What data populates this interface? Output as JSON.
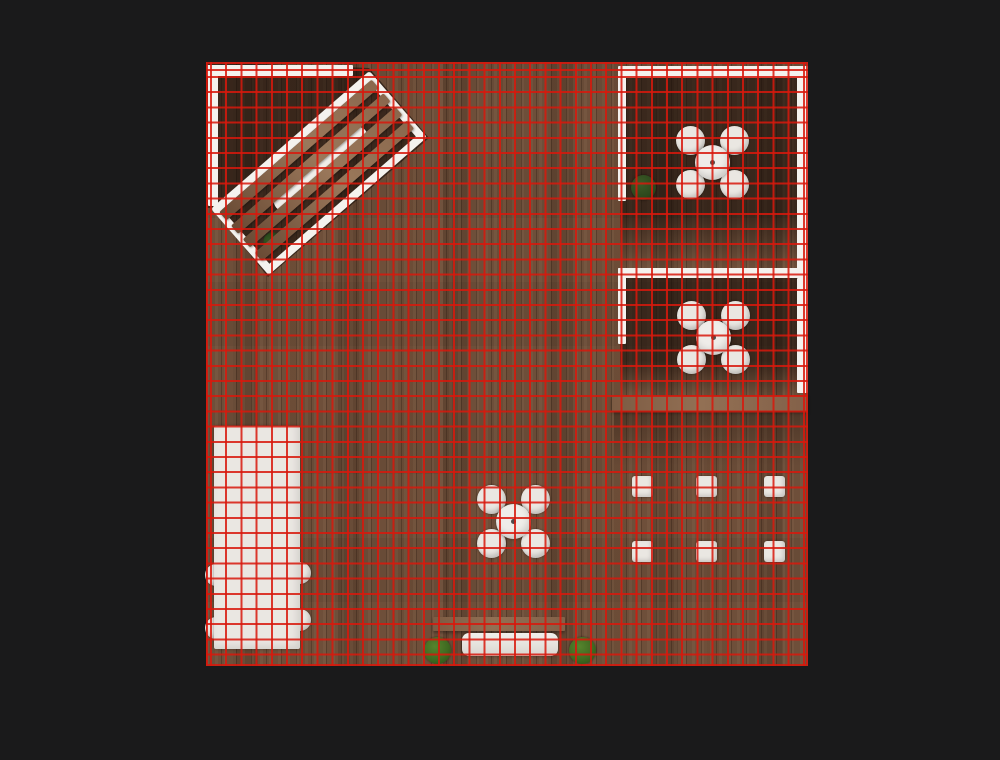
{
  "meta": {
    "description": "Top-down rendered view of a wooden-floor cafe/room with a red navigation grid overlay",
    "viewport": {
      "width": 1000,
      "height": 760,
      "background": "#1a1a1b"
    }
  },
  "colors": {
    "background": "#1a1a1b",
    "floor": "#6e4f3a",
    "grid": "rgba(216,24,12,0.85)",
    "wall": "#f4f2ee",
    "furniture_white": "#eae7e2",
    "table_top": "#efede9",
    "table_dot": "#4c4c4c",
    "beam_wood": "#8a684e",
    "plant_dark": "#2c481c",
    "plant_bright": "#3f6a21",
    "shadow": "rgba(16,9,5,0.55)"
  },
  "scene": {
    "floor": {
      "x": 206,
      "y": 62,
      "w": 602,
      "h": 604
    },
    "grid": {
      "spacing": 15.2,
      "line_width": 2,
      "offset_x": 2,
      "offset_y": 12
    },
    "shadows": [
      {
        "name": "pergola-corner-shadow",
        "type": "poly",
        "points": "0px 0px, 163px 6px, 223px 76px, 62px 215px, 7px 146px, 0px 146px"
      },
      {
        "name": "top-right-room-shadow",
        "type": "rect",
        "x": 414,
        "y": 14,
        "w": 186,
        "h": 192,
        "fade": true
      },
      {
        "name": "mid-right-room-shadow",
        "type": "rect",
        "x": 414,
        "y": 208,
        "w": 186,
        "h": 126,
        "fade": true
      },
      {
        "name": "below-beam-shadow",
        "type": "rect",
        "x": 408,
        "y": 349,
        "w": 194,
        "h": 55,
        "light": true
      }
    ],
    "walls": [
      {
        "name": "wall-top-left-horizontal",
        "x": 0,
        "y": 3,
        "w": 147,
        "h": 11
      },
      {
        "name": "wall-left-vertical",
        "x": 2,
        "y": 3,
        "w": 10,
        "h": 141
      },
      {
        "name": "wall-top-right-horizontal",
        "x": 414,
        "y": 4,
        "w": 188,
        "h": 12
      },
      {
        "name": "wall-top-right-room-left",
        "x": 412,
        "y": 4,
        "w": 8,
        "h": 135
      },
      {
        "name": "wall-right-upper",
        "x": 591,
        "y": 4,
        "w": 11,
        "h": 205
      },
      {
        "name": "wall-right-lower",
        "x": 591,
        "y": 216,
        "w": 11,
        "h": 115
      },
      {
        "name": "wall-mid-right-room-top",
        "x": 412,
        "y": 206,
        "w": 190,
        "h": 10
      },
      {
        "name": "wall-mid-right-room-left",
        "x": 412,
        "y": 206,
        "w": 8,
        "h": 76
      }
    ],
    "beams": [
      {
        "name": "wood-beam-divider",
        "x": 406,
        "y": 334,
        "w": 196,
        "h": 15
      },
      {
        "name": "bench-back-bar",
        "x": 227,
        "y": 555,
        "w": 132,
        "h": 14
      }
    ],
    "bench_seat": {
      "name": "bench-seat",
      "x": 256,
      "y": 571,
      "w": 96,
      "h": 23
    },
    "counter": {
      "name": "counter-table",
      "x": 8,
      "y": 364,
      "w": 86,
      "h": 223,
      "chair_d": 22,
      "chairs": [
        {
          "cx": 10,
          "cy": 513
        },
        {
          "cx": 10,
          "cy": 566
        },
        {
          "cx": 94,
          "cy": 511
        },
        {
          "cx": 94,
          "cy": 558
        }
      ]
    },
    "dining_sets": {
      "table_d": 35,
      "chair_d": 29,
      "chair_offset": 22,
      "dot_d": 5,
      "items": [
        {
          "name": "dining-set-top-right",
          "cx": 506,
          "cy": 100
        },
        {
          "name": "dining-set-mid-right",
          "cx": 507,
          "cy": 275
        },
        {
          "name": "dining-set-center",
          "cx": 307,
          "cy": 459
        }
      ]
    },
    "stools": {
      "size": 21,
      "items": [
        {
          "cx": 436,
          "cy": 424
        },
        {
          "cx": 500,
          "cy": 424
        },
        {
          "cx": 568,
          "cy": 424
        },
        {
          "cx": 436,
          "cy": 489
        },
        {
          "cx": 500,
          "cy": 489
        },
        {
          "cx": 568,
          "cy": 489
        }
      ]
    },
    "plants": [
      {
        "name": "potted-plant-top-right-room",
        "cx": 437,
        "cy": 125,
        "d": 25,
        "tone": "dark"
      },
      {
        "name": "bush-bench-left",
        "cx": 231,
        "cy": 588,
        "d": 27,
        "tone": "bright"
      },
      {
        "name": "bush-bench-right",
        "cx": 376,
        "cy": 588,
        "d": 27,
        "tone": "bright"
      }
    ],
    "pergola": {
      "name": "pergola-slatted-structure",
      "cx": 113,
      "cy": 111,
      "w": 210,
      "h": 88,
      "rotation_deg": -41,
      "frame": 8,
      "slats": {
        "ys": [
          0,
          18,
          36,
          54
        ],
        "h": 11
      },
      "table": {
        "x": 42,
        "y": 24,
        "w": 118,
        "h": 20
      },
      "plant": {
        "x": 8,
        "y": 48,
        "d": 18
      }
    }
  }
}
